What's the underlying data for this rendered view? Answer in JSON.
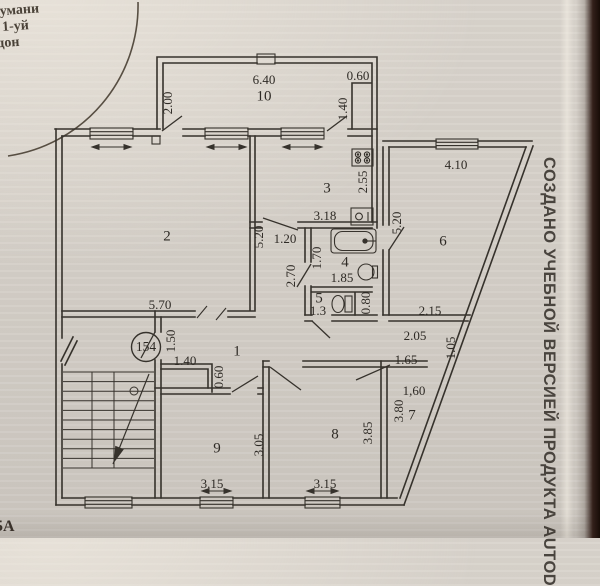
{
  "photo": {
    "paper_color": "#d6d1c9",
    "ink_color": "#36322c",
    "edge_color": "#20130d"
  },
  "stamp": {
    "lines": [
      "тумани",
      "1-уй",
      "дон"
    ]
  },
  "watermark": {
    "text": "СОЗДАНО УЧЕБНОЙ ВЕРСИЕЙ ПРОДУКТА AUTOD"
  },
  "corner_text": "5А",
  "plan": {
    "apartment_number": "154",
    "rooms": [
      {
        "n": "1",
        "x": 237,
        "y": 352
      },
      {
        "n": "2",
        "x": 167,
        "y": 237
      },
      {
        "n": "3",
        "x": 327,
        "y": 189
      },
      {
        "n": "4",
        "x": 345,
        "y": 263
      },
      {
        "n": "5",
        "x": 319,
        "y": 299
      },
      {
        "n": "6",
        "x": 443,
        "y": 242
      },
      {
        "n": "7",
        "x": 412,
        "y": 416
      },
      {
        "n": "8",
        "x": 335,
        "y": 435
      },
      {
        "n": "9",
        "x": 217,
        "y": 449
      },
      {
        "n": "10",
        "x": 264,
        "y": 97
      }
    ],
    "dimensions": [
      {
        "t": "6.40",
        "x": 264,
        "y": 81
      },
      {
        "t": "0.60",
        "x": 358,
        "y": 77
      },
      {
        "t": "2.00",
        "x": 169,
        "y": 103,
        "r": -90
      },
      {
        "t": "1.40",
        "x": 344,
        "y": 109,
        "r": -90
      },
      {
        "t": "4.10",
        "x": 456,
        "y": 166
      },
      {
        "t": "5.20",
        "x": 398,
        "y": 223,
        "r": -90
      },
      {
        "t": "2.55",
        "x": 364,
        "y": 182,
        "r": -90
      },
      {
        "t": "5.20",
        "x": 260,
        "y": 237,
        "r": -90
      },
      {
        "t": "3.18",
        "x": 325,
        "y": 217
      },
      {
        "t": "1.20",
        "x": 285,
        "y": 240
      },
      {
        "t": "1.70",
        "x": 318,
        "y": 258,
        "r": -90
      },
      {
        "t": "2.70",
        "x": 292,
        "y": 276,
        "r": -90
      },
      {
        "t": "1.85",
        "x": 342,
        "y": 279
      },
      {
        "t": "1.3",
        "x": 318,
        "y": 312
      },
      {
        "t": "0.80",
        "x": 367,
        "y": 303,
        "r": -90
      },
      {
        "t": "5.70",
        "x": 160,
        "y": 306
      },
      {
        "t": "1.50",
        "x": 172,
        "y": 341,
        "r": -90
      },
      {
        "t": "1.40",
        "x": 185,
        "y": 362
      },
      {
        "t": "0.60",
        "x": 220,
        "y": 377,
        "r": -90
      },
      {
        "t": "2.15",
        "x": 430,
        "y": 312
      },
      {
        "t": "2.05",
        "x": 415,
        "y": 337
      },
      {
        "t": "1.05",
        "x": 452,
        "y": 348,
        "r": -90,
        "s": 9.5
      },
      {
        "t": "1.65",
        "x": 406,
        "y": 361
      },
      {
        "t": "1,60",
        "x": 414,
        "y": 392
      },
      {
        "t": "3.80",
        "x": 400,
        "y": 411,
        "r": -90
      },
      {
        "t": "3.05",
        "x": 260,
        "y": 445,
        "r": -90
      },
      {
        "t": "3.85",
        "x": 369,
        "y": 433,
        "r": -90
      },
      {
        "t": "3.15",
        "x": 212,
        "y": 485
      },
      {
        "t": "3.15",
        "x": 325,
        "y": 485
      }
    ]
  }
}
